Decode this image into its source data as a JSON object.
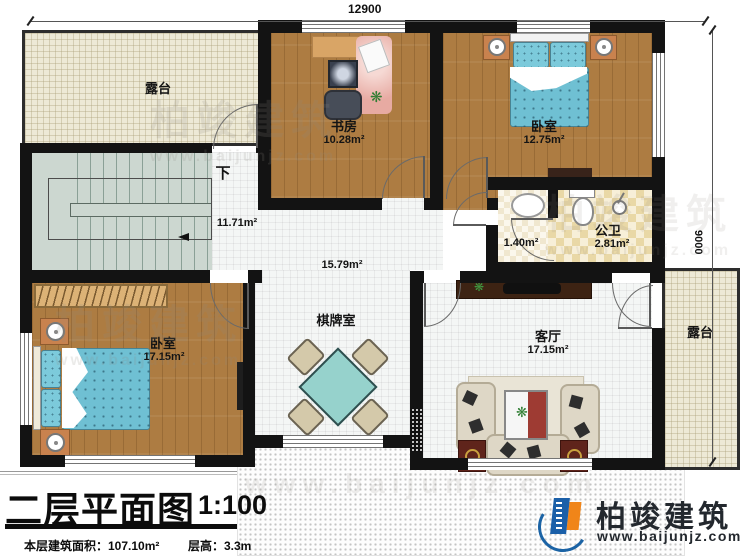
{
  "dimensions": {
    "top": "12900",
    "right": "9000"
  },
  "rooms": {
    "terrace_tl": {
      "name": "露台"
    },
    "terrace_r": {
      "name": "露台"
    },
    "stairs": {
      "direction": "下",
      "area": "11.71m²"
    },
    "study": {
      "name": "书房",
      "area": "10.28m²"
    },
    "bedroom_tr": {
      "name": "卧室",
      "area": "12.75m²"
    },
    "wash": {
      "area": "1.40m²"
    },
    "bath": {
      "name": "公卫",
      "area": "2.81m²"
    },
    "hall": {
      "area": "15.79m²"
    },
    "game_room": {
      "name": "棋牌室"
    },
    "bedroom_bl": {
      "name": "卧室",
      "area": "17.15m²"
    },
    "living": {
      "name": "客厅",
      "area": "17.15m²"
    }
  },
  "title_block": {
    "title": "二层平面图",
    "scale": "1:100",
    "area_text": "本层建筑面积：107.10m²",
    "floor_height_text": "层高：3.3m"
  },
  "brand": {
    "name": "柏竣建筑",
    "url": "www.baijunjz.com"
  },
  "watermark": {
    "name": "柏竣建筑",
    "url": "www.baijunjz.com"
  }
}
